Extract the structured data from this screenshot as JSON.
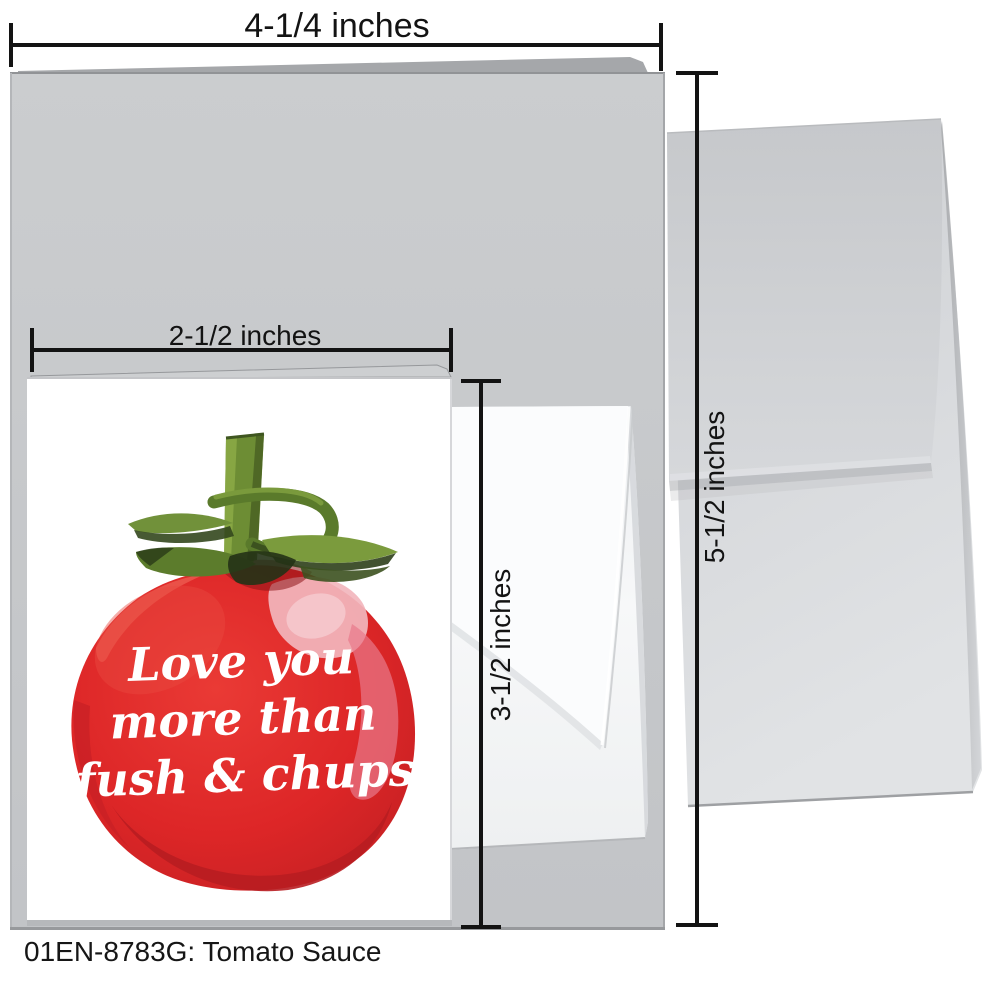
{
  "caption": "01EN-8783G: Tomato Sauce",
  "dimensions": {
    "large_card_width": "4-1/4 inches",
    "large_card_height": "5-1/2 inches",
    "small_card_width": "2-1/2 inches",
    "small_card_height": "3-1/2 inches"
  },
  "card_message": {
    "line1": "Love you",
    "line2": "more than",
    "line3": "fush & chups"
  },
  "colors": {
    "tomato_red": "#e2292a",
    "tomato_dark_red": "#b81d21",
    "tomato_pink_highlight": "#f2b6bd",
    "stem_green": "#6d8d34",
    "stem_dark_green": "#33471d",
    "large_card_gray": "#c7c9cb",
    "envelope_gray": "#d6d8db",
    "small_envelope_white": "#f5f6f7",
    "dimension_line_black": "#131313",
    "message_text_white": "#ffffff"
  }
}
